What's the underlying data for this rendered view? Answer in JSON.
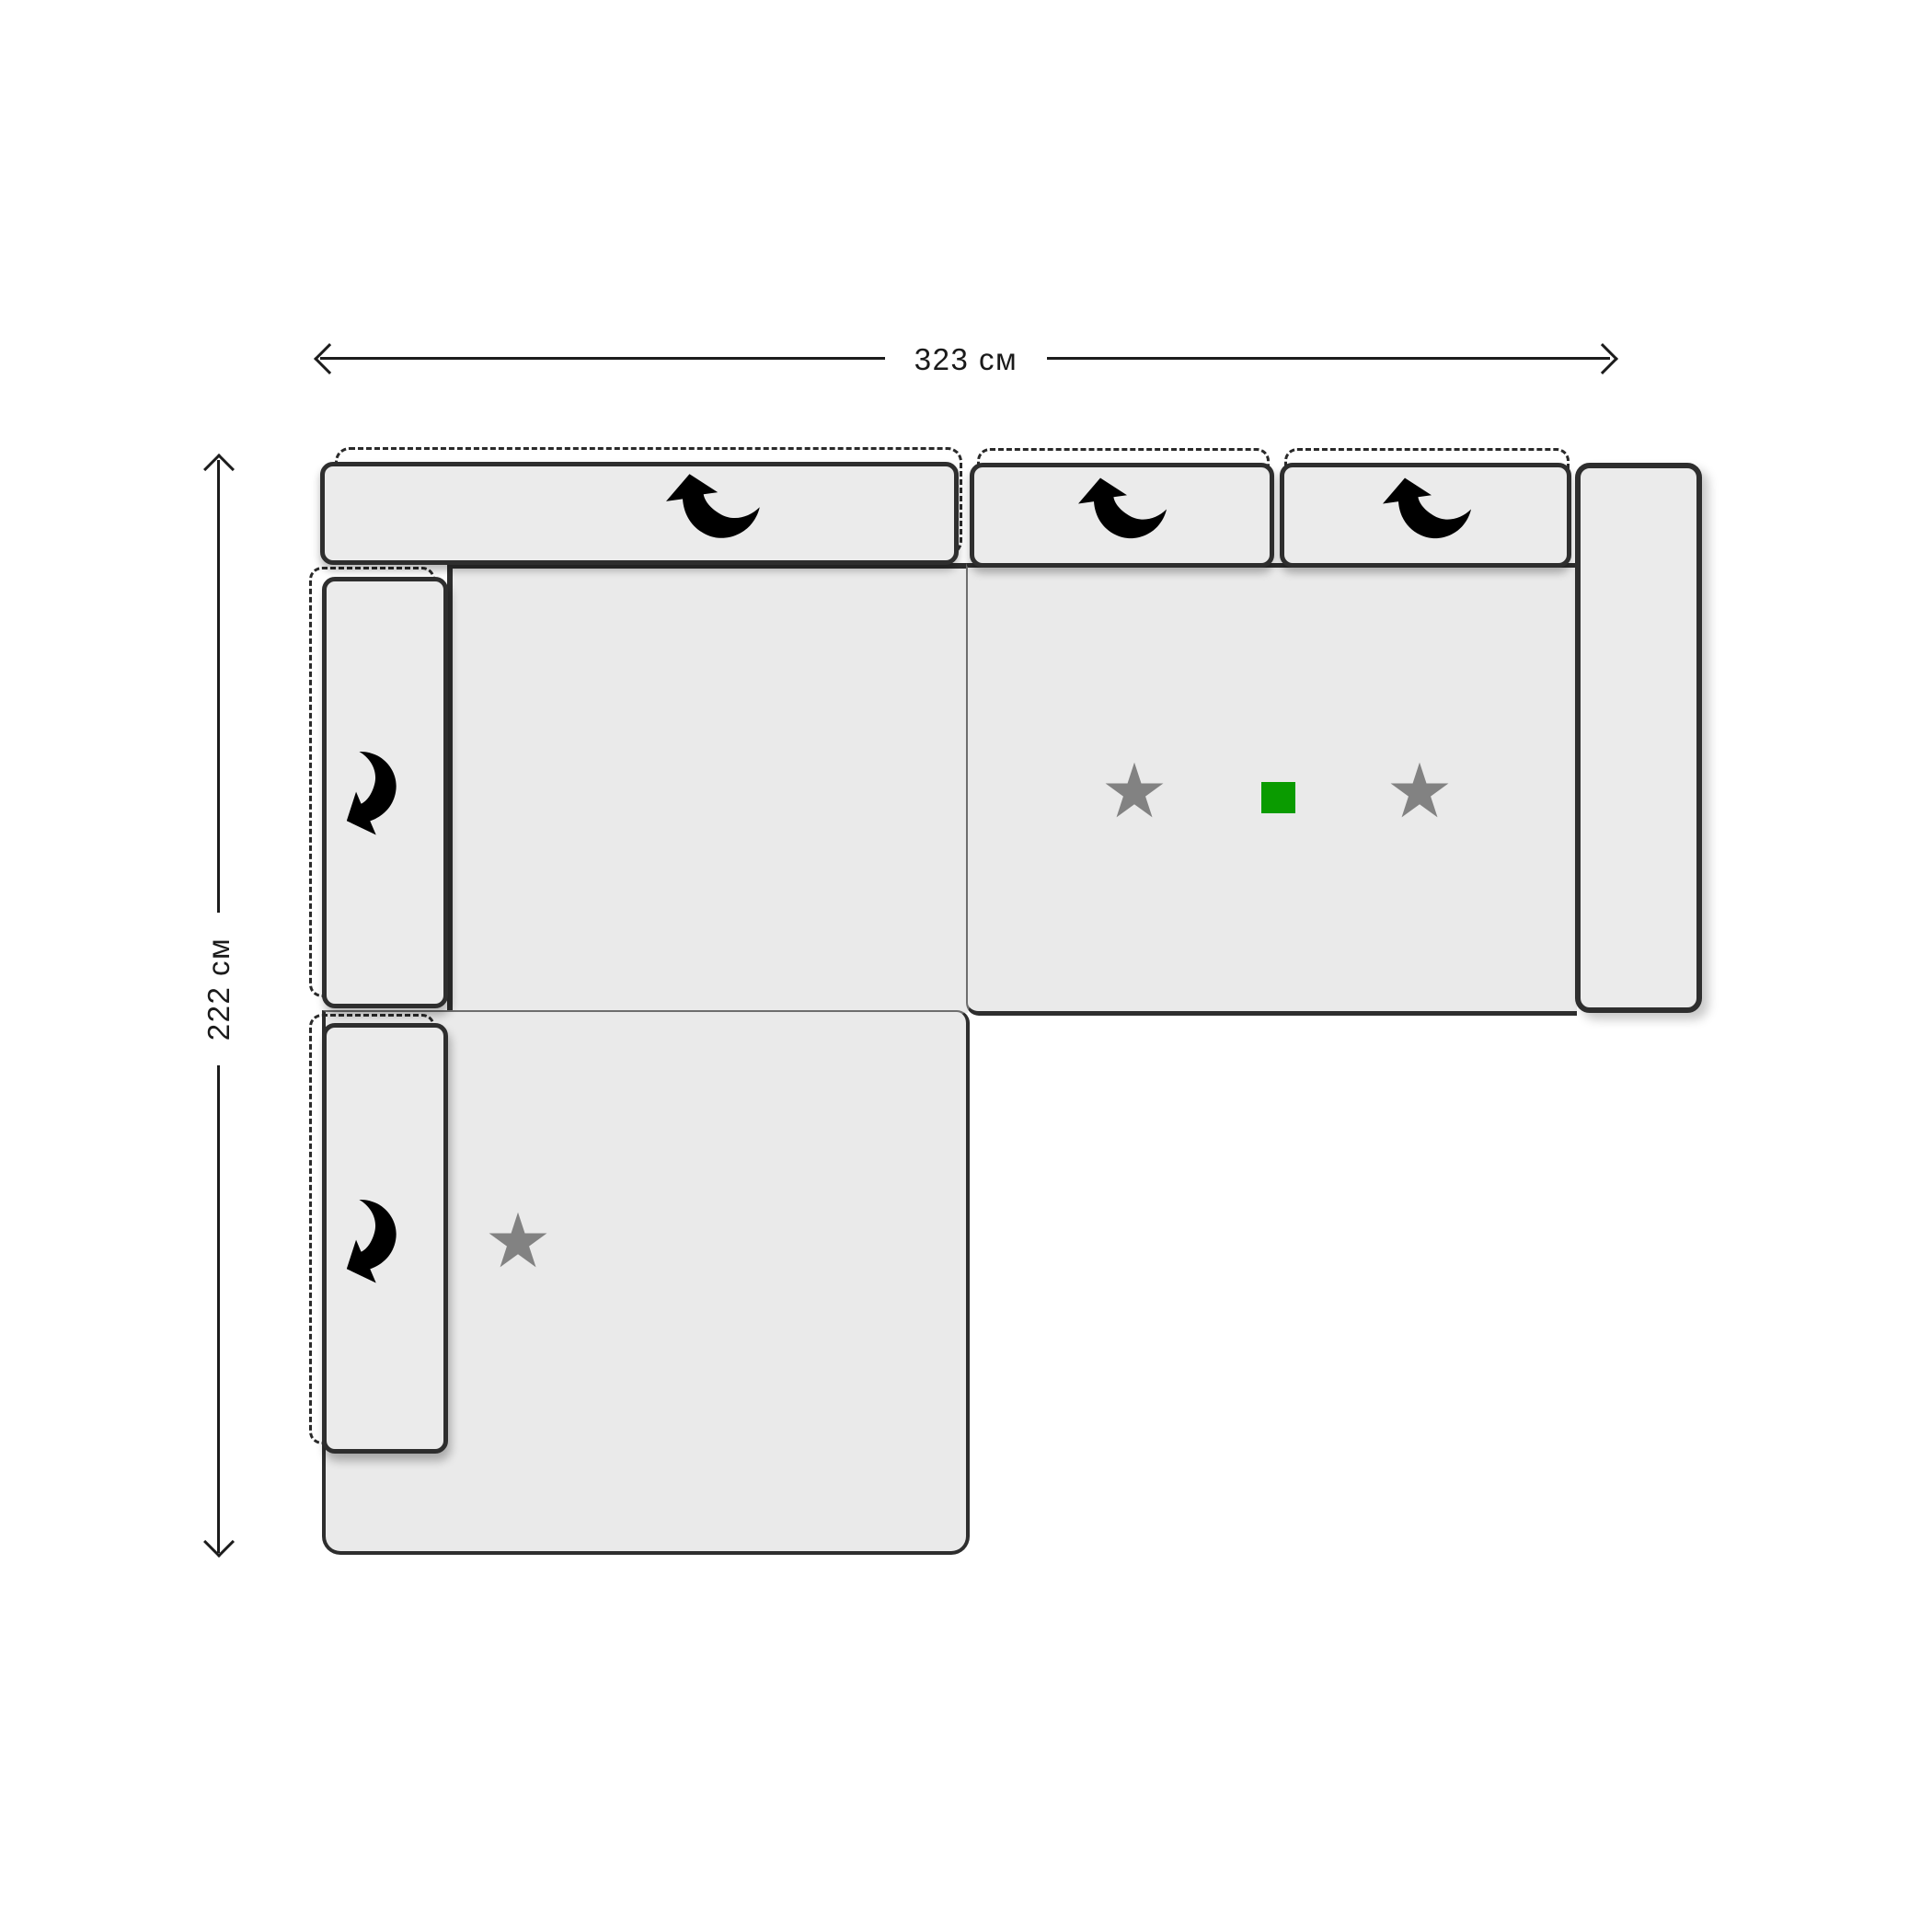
{
  "diagram": {
    "kind": "sofa-top-view-schematic",
    "dimensions": {
      "width": {
        "label": "323 см"
      },
      "height": {
        "label": "222 см"
      }
    },
    "modules": {
      "backrests": [
        {
          "id": "backrest-wide",
          "icon": "curved-arrow-icon"
        },
        {
          "id": "backrest-middle",
          "icon": "curved-arrow-icon"
        },
        {
          "id": "backrest-right",
          "icon": "curved-arrow-icon"
        }
      ],
      "armrests": [
        {
          "id": "armrest-left-top",
          "icon": "curved-arrow-icon"
        },
        {
          "id": "armrest-left-bottom",
          "icon": "curved-arrow-icon"
        },
        {
          "id": "armrest-right"
        }
      ],
      "seats": [
        {
          "id": "seat-left"
        },
        {
          "id": "seat-right",
          "markers": [
            "star",
            "green-square",
            "star"
          ]
        },
        {
          "id": "chaise",
          "markers": [
            "star"
          ]
        }
      ]
    },
    "markers": {
      "star_glyph": "★",
      "star_count": 3,
      "green_square_color": "#0a9b00"
    }
  },
  "colors": {
    "background": "#ffffff",
    "sofa_fill": "#eaeaea",
    "cushion_fill": "#ebebeb",
    "outline": "#2e2e2e",
    "seam": "#6e6e6e",
    "dashed_outline": "#2a2a2a",
    "arrow_icon": "#3a3a3a",
    "star": "#828282",
    "green_marker": "#0a9b00",
    "dimension_line": "#1c1c1c",
    "dimension_text": "#1a1a1a"
  }
}
